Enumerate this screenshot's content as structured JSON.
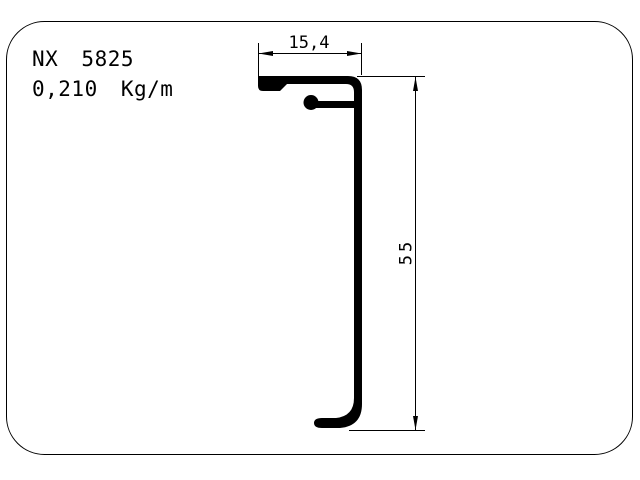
{
  "page": {
    "background_color": "#ffffff",
    "line_color": "#000000"
  },
  "title_block": {
    "profile_code": "NX 5825",
    "weight_per_meter": "0,210 Kg/m"
  },
  "dimensions": {
    "top_width_mm": "15,4",
    "right_height_mm": "55"
  },
  "drawing": {
    "type": "aluminum-extrusion-profile-cross-section",
    "border": "rounded-rectangle"
  }
}
